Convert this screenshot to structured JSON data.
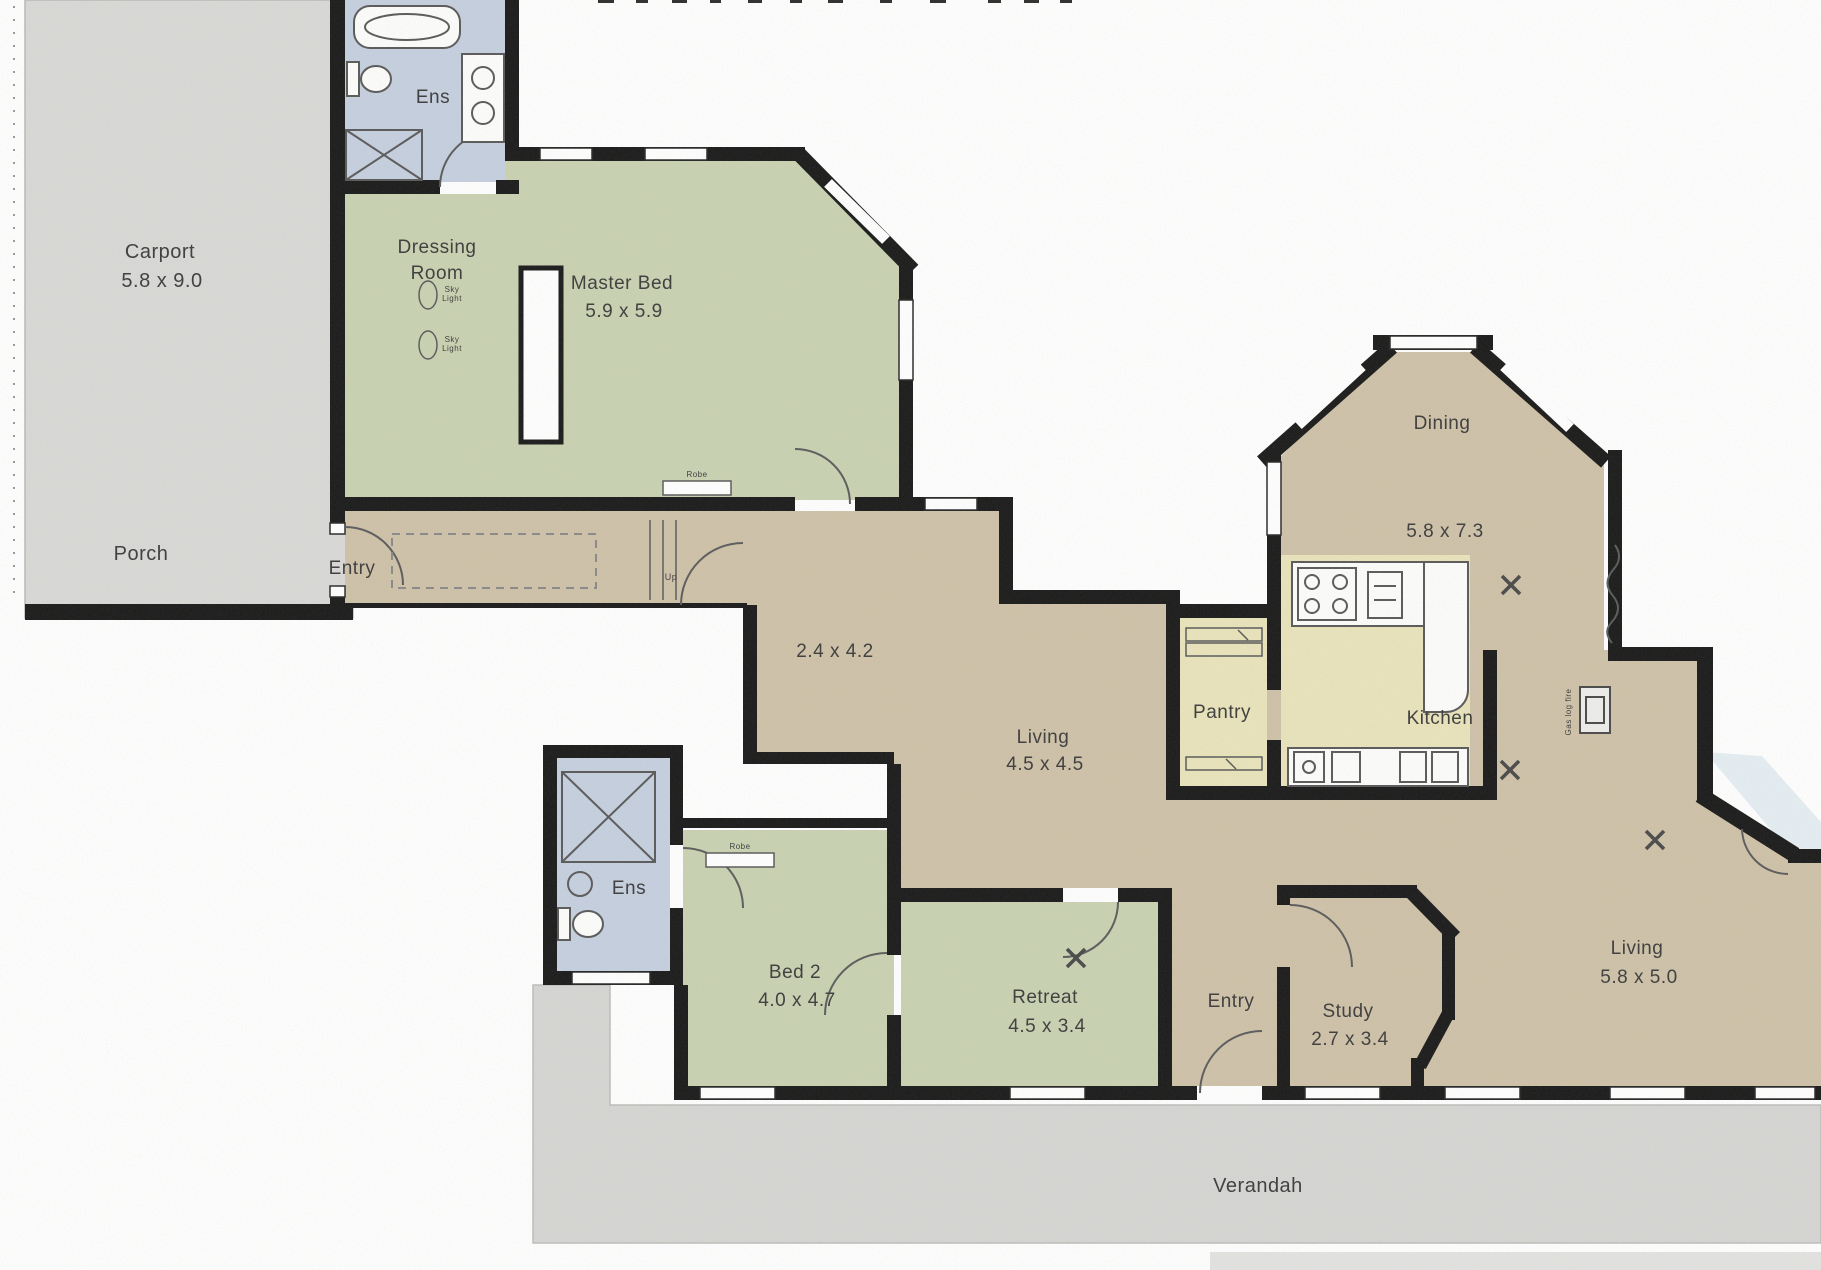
{
  "floor_plan": {
    "colors": {
      "wall": "#1b1b1b",
      "room_green": "#c9d2b2",
      "room_tan": "#cfc2a9",
      "room_yellow": "#e9e4bb",
      "room_blue": "#c6d0df",
      "exterior_grey": "#d9d9d7",
      "verandah_grey": "#d6d6d4",
      "label": "#3d3d3d"
    },
    "rooms": [
      {
        "id": "carport",
        "label": "Carport",
        "dims": "5.8 x 9.0"
      },
      {
        "id": "porch",
        "label": "Porch",
        "dims": ""
      },
      {
        "id": "ens-master",
        "label": "Ens",
        "dims": ""
      },
      {
        "id": "dressing-room",
        "label": "Dressing Room",
        "dims": ""
      },
      {
        "id": "master-bed",
        "label": "Master Bed",
        "dims": "5.9 x 5.9"
      },
      {
        "id": "entry-front",
        "label": "Entry",
        "dims": ""
      },
      {
        "id": "hall",
        "label": "",
        "dims": "2.4 x 4.2"
      },
      {
        "id": "living-family",
        "label": "Living",
        "dims": "4.5 x 4.5"
      },
      {
        "id": "dining",
        "label": "Dining",
        "dims": "5.8 x 7.3"
      },
      {
        "id": "pantry",
        "label": "Pantry",
        "dims": ""
      },
      {
        "id": "kitchen",
        "label": "Kitchen",
        "dims": ""
      },
      {
        "id": "ens-2",
        "label": "Ens",
        "dims": ""
      },
      {
        "id": "bed-2",
        "label": "Bed 2",
        "dims": "4.0 x 4.7"
      },
      {
        "id": "retreat",
        "label": "Retreat",
        "dims": "4.5 x 3.4"
      },
      {
        "id": "entry-rear",
        "label": "Entry",
        "dims": ""
      },
      {
        "id": "study",
        "label": "Study",
        "dims": "2.7 x 3.4"
      },
      {
        "id": "living-rear",
        "label": "Living",
        "dims": "5.8 x 5.0"
      },
      {
        "id": "verandah",
        "label": "Verandah",
        "dims": ""
      }
    ],
    "annotations": {
      "up": "Up",
      "sky_light_line1": "Sky",
      "sky_light_line2": "Light",
      "robe": "Robe",
      "gas_log_fire": "Gas log fire"
    }
  }
}
